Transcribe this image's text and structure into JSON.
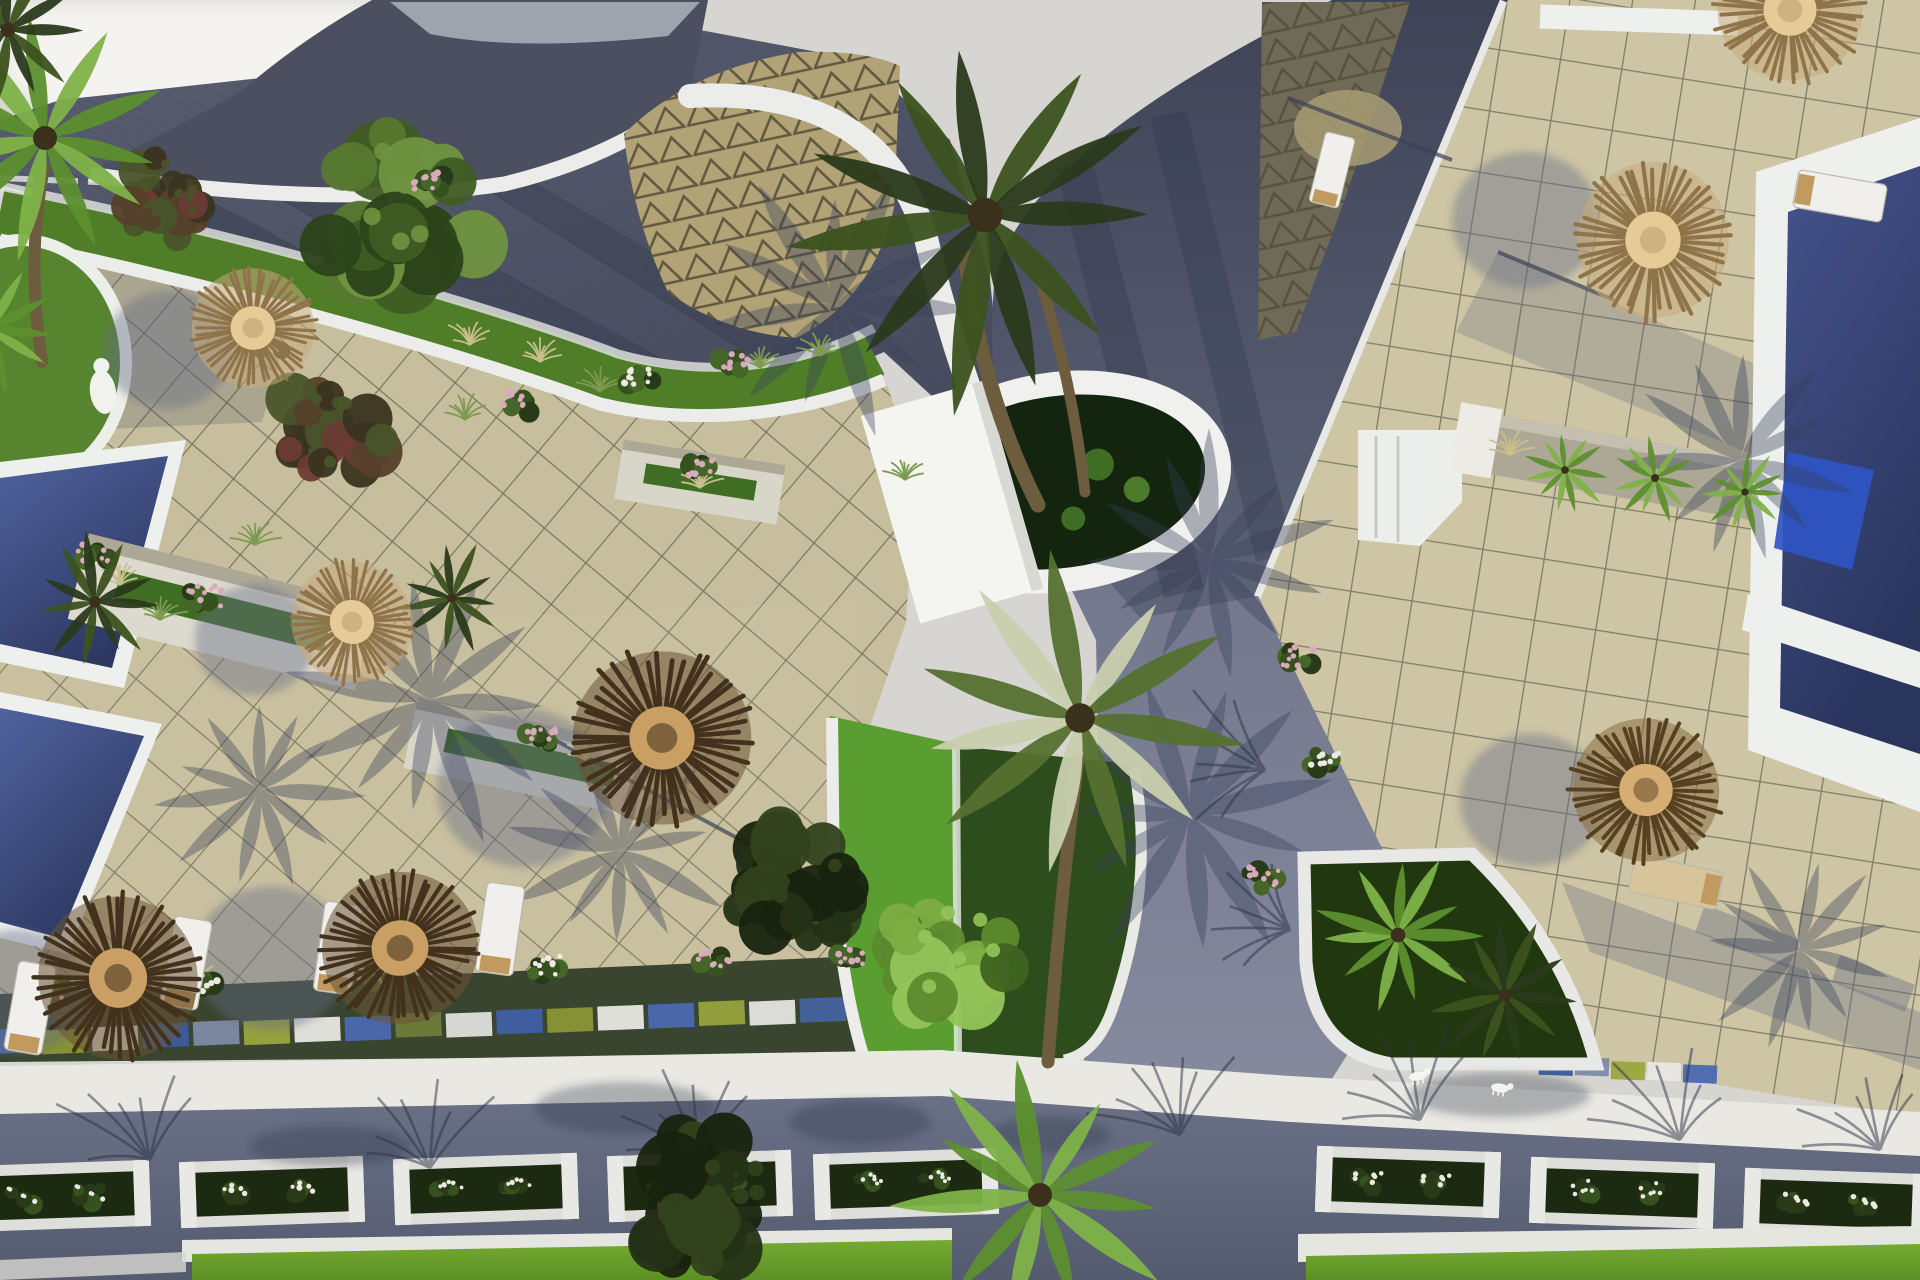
{
  "meta": {
    "title": "Aerial resort courtyard rendering",
    "description": "Top-down aerial 3D architectural rendering of a seaside resort: beige tiled sun terraces with thatched straw umbrellas and white loungers, dark blue swimming pools with white copings, curved white walls, a tan roof with triangular pattern, dark slate paved roads, planters with palms, flowering shrubs, bright green lawns and long afternoon shadows.",
    "image_type": "3D render, top-down aerial view, no visible text",
    "visible_text": []
  },
  "palette": {
    "sky": "#d6d5d1",
    "glow": "#f4f3f0",
    "roof-dark": "#4b4f60",
    "roof-tan": "#b2a377",
    "roof-tri-line": "#4e4731",
    "roof-shadow-tri": "#6f6a57",
    "plaza-top": "#565b6e",
    "plaza-bottom": "#494e60",
    "road-dark": "#3f4457",
    "road-mid": "#5d6378",
    "road-bottom": "#646a7f",
    "junction": "#7d8297",
    "walkway": "#e9e8e3",
    "curb": "#ecedea",
    "tile-left": "#c7be9d",
    "tile-left-line": "#5f5e4c",
    "tile-right": "#cdc5a4",
    "tile-right-line": "#6c6b58",
    "pool-edge": "#eef0ee",
    "pool-deep": "#2c3760",
    "pool-light": "#50639f",
    "pool-bright": "#2f55c4",
    "lawn": "#6aa02c",
    "lawn-dark": "#2e4d1c",
    "planter-bright": "#5a9e31",
    "planter-dark": "#20370f",
    "strip-green": "#4f7d28",
    "strip-soil": "#3a4530",
    "stone": "#ada896",
    "trunk": "#6d5c3e",
    "shadow": "#39405a",
    "tile-shade": "#636b85",
    "straw": "#c9bf8e",
    "grass-green": "#7d9a50",
    "flower-pink": "#d9a9bd",
    "flower-white": "#ece9e2",
    "umbrella": {
      "light": {
        "base": "#c9ab7d",
        "spokes": "#8f7349",
        "center": "#e6cb97"
      },
      "mid": {
        "base": "#8a6b42",
        "spokes": "#55401f",
        "center": "#d6ae74"
      },
      "dark": {
        "base": "#6b5334",
        "spokes": "#42311c",
        "center": "#c99f63"
      }
    },
    "leaf": {
      "greens": [
        "#2c431a",
        "#3f5c23",
        "#57782f",
        "#6f9340"
      ],
      "bright": [
        "#3f6320",
        "#5d8a2d",
        "#7cad43",
        "#94c45a"
      ],
      "dark": [
        "#18230f",
        "#243216",
        "#31421c"
      ],
      "red": [
        "#3a3420",
        "#55402a",
        "#6b3b33",
        "#49542a"
      ]
    },
    "palmColors": {
      "dark": [
        "#2a3a1b",
        "#3c521f"
      ],
      "bright": [
        "#5d8f2e",
        "#7eb248"
      ],
      "highlight": [
        "#55702f",
        "#c9cfae"
      ]
    }
  },
  "objects": {
    "umbrellas": [
      {
        "x": 253,
        "y": 328,
        "r": 66,
        "variant": "light",
        "rot": 15
      },
      {
        "x": 352,
        "y": 622,
        "r": 66,
        "variant": "light",
        "rot": 40
      },
      {
        "x": 662,
        "y": 738,
        "r": 96,
        "variant": "dark",
        "rot": 0
      },
      {
        "x": 118,
        "y": 978,
        "r": 88,
        "variant": "dark",
        "rot": 70
      },
      {
        "x": 400,
        "y": 948,
        "r": 84,
        "variant": "dark",
        "rot": 160
      },
      {
        "x": 1653,
        "y": 240,
        "r": 84,
        "variant": "light",
        "rot": 95
      },
      {
        "x": 1790,
        "y": 10,
        "r": 78,
        "variant": "light",
        "rot": 0
      },
      {
        "x": 1646,
        "y": 790,
        "r": 79,
        "variant": "mid",
        "rot": 200
      }
    ],
    "umbrella_shadows": [
      {
        "x": 168,
        "y": 350,
        "r": 64
      },
      {
        "x": 255,
        "y": 640,
        "r": 60
      },
      {
        "x": 523,
        "y": 788,
        "r": 86
      },
      {
        "x": 272,
        "y": 958,
        "r": 78
      },
      {
        "x": 18,
        "y": 992,
        "r": 68
      },
      {
        "x": 1526,
        "y": 220,
        "r": 74
      },
      {
        "x": 1532,
        "y": 800,
        "r": 72
      }
    ],
    "pole_shadows": [
      {
        "x1": 1498,
        "y1": 252,
        "x2": 1614,
        "y2": 300
      },
      {
        "x1": 1288,
        "y1": 98,
        "x2": 1452,
        "y2": 160
      },
      {
        "x1": 540,
        "y1": 732,
        "x2": 830,
        "y2": 888
      }
    ],
    "palms": [
      {
        "x": 985,
        "y": 215,
        "r": 215,
        "variant": "dark"
      },
      {
        "x": 1080,
        "y": 718,
        "r": 185,
        "variant": "highlight"
      },
      {
        "x": 1040,
        "y": 1195,
        "r": 150,
        "variant": "bright"
      },
      {
        "x": 45,
        "y": 138,
        "r": 150,
        "variant": "bright"
      },
      {
        "x": 95,
        "y": 602,
        "r": 72,
        "variant": "dark"
      },
      {
        "x": 1398,
        "y": 935,
        "r": 92,
        "variant": "bright"
      },
      {
        "x": 1505,
        "y": 995,
        "r": 80,
        "variant": "dark"
      },
      {
        "x": 1565,
        "y": 470,
        "r": 48,
        "variant": "bright"
      },
      {
        "x": 1655,
        "y": 478,
        "r": 50,
        "variant": "bright"
      },
      {
        "x": 1745,
        "y": 492,
        "r": 46,
        "variant": "bright"
      },
      {
        "x": -10,
        "y": 330,
        "r": 85,
        "variant": "bright"
      },
      {
        "x": 8,
        "y": 30,
        "r": 90,
        "variant": "dark"
      },
      {
        "x": 452,
        "y": 598,
        "r": 60,
        "variant": "dark"
      }
    ],
    "palm_trunks": [
      {
        "d": "M1038,505 Q980,390 966,258",
        "w": 15
      },
      {
        "d": "M1085,492 Q1072,380 1040,280",
        "w": 11
      },
      {
        "d": "M1048,1062 Q1060,900 1078,760",
        "w": 13
      },
      {
        "d": "M42,362 Q26,258 44,168",
        "w": 12
      }
    ],
    "trees": [
      {
        "x": 402,
        "y": 212,
        "r": 110,
        "pal": "greens"
      },
      {
        "x": 948,
        "y": 958,
        "r": 88,
        "pal": "bright"
      },
      {
        "x": 790,
        "y": 888,
        "r": 86,
        "pal": "dark"
      },
      {
        "x": 705,
        "y": 1198,
        "r": 98,
        "pal": "dark"
      },
      {
        "x": 335,
        "y": 432,
        "r": 75,
        "pal": "red"
      },
      {
        "x": 162,
        "y": 198,
        "r": 58,
        "pal": "red"
      }
    ],
    "bushes": [
      {
        "x": 45,
        "y": 992,
        "f": "pink"
      },
      {
        "x": 205,
        "y": 986,
        "f": "white"
      },
      {
        "x": 375,
        "y": 978,
        "f": "pink"
      },
      {
        "x": 545,
        "y": 970,
        "f": "white"
      },
      {
        "x": 715,
        "y": 964,
        "f": "pink"
      },
      {
        "x": 852,
        "y": 960,
        "f": "pink"
      },
      {
        "x": 520,
        "y": 404,
        "f": "pink"
      },
      {
        "x": 735,
        "y": 366,
        "f": "pink"
      },
      {
        "x": 640,
        "y": 380,
        "f": "white"
      },
      {
        "x": 205,
        "y": 600,
        "f": "pink"
      },
      {
        "x": 540,
        "y": 742,
        "f": "pink"
      },
      {
        "x": 700,
        "y": 470,
        "f": "pink"
      },
      {
        "x": 95,
        "y": 555,
        "f": "pink"
      },
      {
        "x": 270,
        "y": 345,
        "f": "pink"
      },
      {
        "x": 430,
        "y": 185,
        "f": "pink"
      },
      {
        "x": 1298,
        "y": 660,
        "f": "pink"
      },
      {
        "x": 1322,
        "y": 762,
        "f": "white"
      },
      {
        "x": 1262,
        "y": 880,
        "f": "pink"
      }
    ],
    "grass_tufts": [
      {
        "x": 470,
        "y": 345,
        "t": "straw"
      },
      {
        "x": 540,
        "y": 362,
        "t": "straw"
      },
      {
        "x": 120,
        "y": 585,
        "t": "straw"
      },
      {
        "x": 255,
        "y": 545,
        "t": "green"
      },
      {
        "x": 465,
        "y": 420,
        "t": "green"
      },
      {
        "x": 600,
        "y": 392,
        "t": "green"
      },
      {
        "x": 760,
        "y": 368,
        "t": "green"
      },
      {
        "x": 160,
        "y": 620,
        "t": "green"
      },
      {
        "x": 585,
        "y": 760,
        "t": "straw"
      },
      {
        "x": 700,
        "y": 488,
        "t": "straw"
      },
      {
        "x": 1510,
        "y": 455,
        "t": "straw"
      },
      {
        "x": 38,
        "y": 995,
        "t": "green"
      },
      {
        "x": 198,
        "y": 985,
        "t": "straw"
      },
      {
        "x": 820,
        "y": 356,
        "t": "green"
      },
      {
        "x": 905,
        "y": 480,
        "t": "green"
      }
    ],
    "loungers": [
      {
        "x": 30,
        "y": 1008,
        "rot": 10
      },
      {
        "x": 186,
        "y": 963,
        "rot": 10
      },
      {
        "x": 338,
        "y": 948,
        "rot": 8
      },
      {
        "x": 500,
        "y": 929,
        "rot": 8
      },
      {
        "x": 1332,
        "y": 170,
        "rot": 14,
        "s": 0.8
      },
      {
        "x": 1840,
        "y": 196,
        "rot": 100
      },
      {
        "x": 1676,
        "y": 882,
        "rot": -78,
        "variant": "tan"
      }
    ],
    "planter_boxes": [
      {
        "x": 58,
        "y": 1196,
        "rot": -2
      },
      {
        "x": 272,
        "y": 1192,
        "rot": -2
      },
      {
        "x": 486,
        "y": 1189,
        "rot": -2
      },
      {
        "x": 700,
        "y": 1186,
        "rot": -2
      },
      {
        "x": 906,
        "y": 1184,
        "rot": -2
      },
      {
        "x": 1408,
        "y": 1182,
        "rot": 2
      },
      {
        "x": 1622,
        "y": 1193,
        "rot": 2
      },
      {
        "x": 1836,
        "y": 1204,
        "rot": 2
      }
    ],
    "mosaic": [
      {
        "x1": 14,
        "y1": 1042,
        "x2": 924,
        "y2": 1006,
        "n": 19,
        "w": 46,
        "h": 24,
        "rot": -2.3
      },
      {
        "x1": 1556,
        "y1": 1066,
        "x2": 1700,
        "y2": 1074,
        "n": 5,
        "w": 34,
        "h": 18,
        "rot": 2
      }
    ],
    "mosaic_colors": [
      "#4a69b0",
      "#8a9636",
      "#e8e8e4",
      "#3c5c9e",
      "#7e8aa6",
      "#9aa63e",
      "#e8e8e4",
      "#4a69b0",
      "#6f7d3a",
      "#dfe0dc",
      "#3f60a6",
      "#8a9636",
      "#e8e8e4",
      "#4a69b0",
      "#97a33c",
      "#e4e5e1",
      "#44639f",
      "#808c38",
      "#e6e7e3"
    ],
    "frond_shadows": [
      {
        "x": 430,
        "y": 700,
        "r": 150,
        "rot": 25
      },
      {
        "x": 620,
        "y": 850,
        "r": 120,
        "rot": -15
      },
      {
        "x": 1190,
        "y": 815,
        "r": 150,
        "rot": 15
      },
      {
        "x": 1740,
        "y": 460,
        "r": 120,
        "rot": 40
      },
      {
        "x": 1800,
        "y": 950,
        "r": 110,
        "rot": 10
      },
      {
        "x": 260,
        "y": 790,
        "r": 110,
        "rot": 60
      },
      {
        "x": 835,
        "y": 305,
        "r": 140,
        "rot": -30
      },
      {
        "x": 1210,
        "y": 560,
        "r": 130,
        "rot": 10
      }
    ],
    "branch_shadows": [
      {
        "x": 150,
        "y": 1160,
        "rot": -15
      },
      {
        "x": 430,
        "y": 1168,
        "rot": -8
      },
      {
        "x": 700,
        "y": 1158,
        "rot": -12
      },
      {
        "x": 1180,
        "y": 1135,
        "rot": -10
      },
      {
        "x": 1420,
        "y": 1120,
        "rot": -14
      },
      {
        "x": 1680,
        "y": 1140,
        "rot": -8
      },
      {
        "x": 1880,
        "y": 1150,
        "rot": -16
      },
      {
        "x": 1290,
        "y": 930,
        "rot": -60
      },
      {
        "x": 1265,
        "y": 770,
        "rot": -70
      }
    ],
    "blob_shadows": [
      {
        "x": 625,
        "y": 1108,
        "rx": 90,
        "ry": 26
      },
      {
        "x": 860,
        "y": 1122,
        "rx": 70,
        "ry": 22
      },
      {
        "x": 330,
        "y": 1146,
        "rx": 80,
        "ry": 20
      },
      {
        "x": 1500,
        "y": 1095,
        "rx": 90,
        "ry": 22
      },
      {
        "x": 1050,
        "y": 1135,
        "rx": 60,
        "ry": 18
      }
    ],
    "animals": [
      {
        "x": 1418,
        "y": 1076,
        "rot": -10
      },
      {
        "x": 1500,
        "y": 1088,
        "rot": 8
      }
    ]
  }
}
